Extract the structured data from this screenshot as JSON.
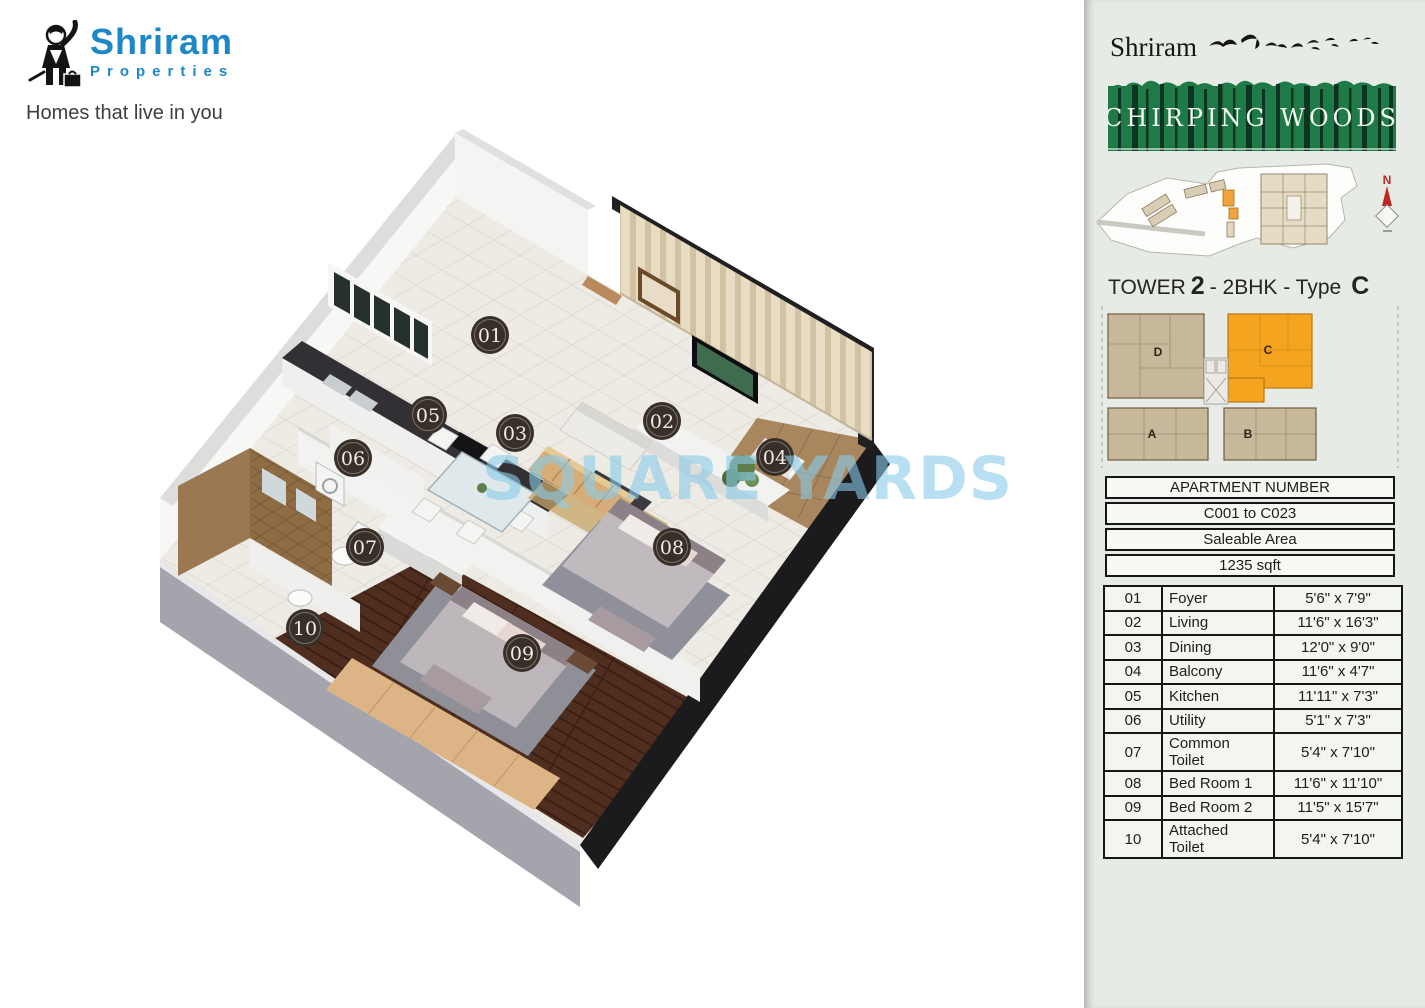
{
  "logo": {
    "brand": "Shriram",
    "brand_sub": "Properties",
    "tagline": "Homes that live in you"
  },
  "floorplan": {
    "watermark": "SQUARE YARDS",
    "markers": [
      {
        "no": "01"
      },
      {
        "no": "02"
      },
      {
        "no": "03"
      },
      {
        "no": "04"
      },
      {
        "no": "05"
      },
      {
        "no": "06"
      },
      {
        "no": "07"
      },
      {
        "no": "08"
      },
      {
        "no": "09"
      },
      {
        "no": "10"
      }
    ]
  },
  "sidebar": {
    "brand": "Shriram",
    "project_name": "CHIRPING WOODS",
    "compass_n": "N",
    "tower": {
      "label": "TOWER",
      "no": "2",
      "mid": "- 2BHK - Type",
      "type": "C"
    },
    "keyplan": {
      "units": [
        {
          "label": "D"
        },
        {
          "label": "C"
        },
        {
          "label": "A"
        },
        {
          "label": "B"
        }
      ]
    },
    "apartment": {
      "header": "APARTMENT NUMBER",
      "range": "C001 to C023",
      "area_label": "Saleable Area",
      "area_value": "1235 sqft"
    },
    "rooms": [
      {
        "no": "01",
        "name": "Foyer",
        "dims": "5'6\" x 7'9\""
      },
      {
        "no": "02",
        "name": "Living",
        "dims": "11'6\" x 16'3\""
      },
      {
        "no": "03",
        "name": "Dining",
        "dims": "12'0\" x 9'0\""
      },
      {
        "no": "04",
        "name": "Balcony",
        "dims": "11'6\" x 4'7\""
      },
      {
        "no": "05",
        "name": "Kitchen",
        "dims": "11'11\" x 7'3\""
      },
      {
        "no": "06",
        "name": "Utility",
        "dims": "5'1\" x 7'3\""
      },
      {
        "no": "07",
        "name": "Common Toilet",
        "dims": "5'4\" x 7'10\""
      },
      {
        "no": "08",
        "name": "Bed Room 1",
        "dims": "11'6\" x 11'10\""
      },
      {
        "no": "09",
        "name": "Bed Room 2",
        "dims": "11'5\" x 15'7\""
      },
      {
        "no": "10",
        "name": "Attached Toilet",
        "dims": "5'4\" x 7'10\""
      }
    ]
  },
  "colors": {
    "logo_blue": "#1e87c8",
    "banner_green": "#1e7a46",
    "keyplan_tan": "#c7b89c",
    "unit_highlight": "#f4a41f",
    "watermark_blue": "#8fcce8",
    "marker_bg": "#372f28"
  }
}
